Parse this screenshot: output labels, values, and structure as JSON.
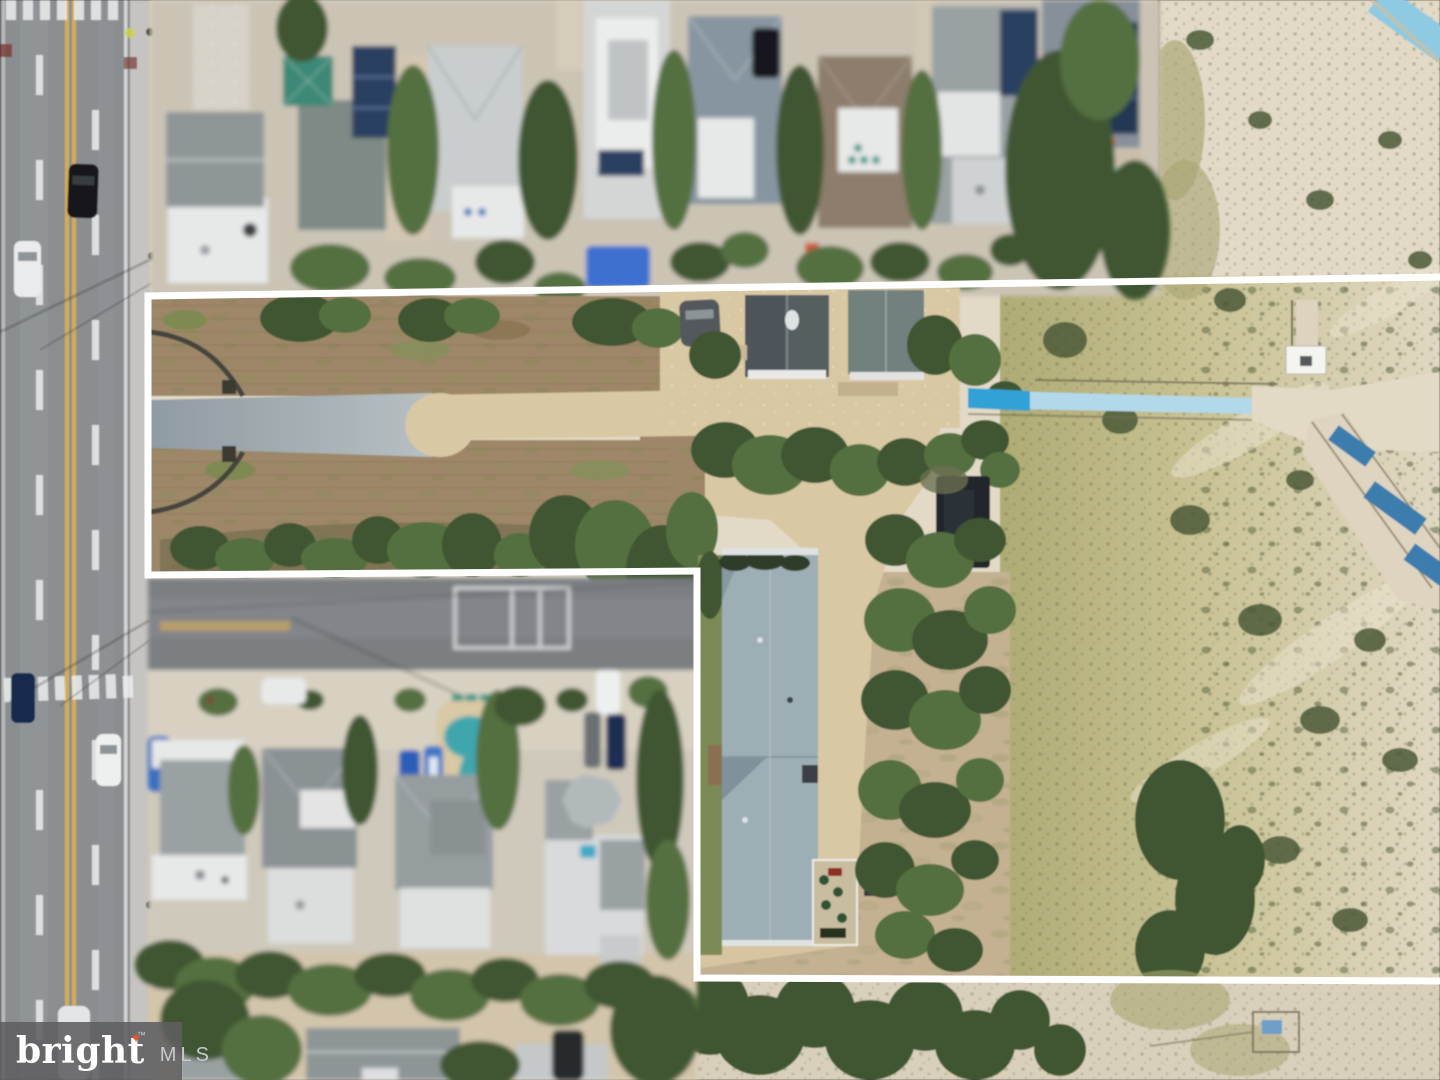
{
  "watermark": {
    "brand": "bright",
    "star": "✦",
    "tm": "™",
    "suffix": "MLS"
  },
  "boundary": {
    "color": "#ffffff",
    "stroke_width": 7,
    "points": [
      [
        1444,
        277
      ],
      [
        148,
        296
      ],
      [
        148,
        575
      ],
      [
        697,
        571
      ],
      [
        697,
        978
      ],
      [
        1444,
        981
      ]
    ]
  },
  "palette": {
    "boundary_white": "#ffffff",
    "road_asphalt": "#8b8e91",
    "road_marking_white": "#eceeee",
    "road_marking_yellow": "#d9ae4e",
    "shoulder_concrete": "#c6c4c0",
    "street_asphalt": "#7c7f82",
    "apron_concrete": "#d8d1c2",
    "lot_dirt": "#9d8767",
    "lot_grass_green": "#7f8a52",
    "dirt_road_sand": "#d9c8a4",
    "paved_stub_gray": "#9aa3a8",
    "tree_dark": "#3f5730",
    "tree_mid": "#547040",
    "dune_sand": "#e2dac7",
    "dune_grass": "#b5b07c",
    "house_roof_gray": "#8f9698",
    "house_white": "#e7e8e8",
    "roof_teal": "#3e8876",
    "roof_brown": "#8d7d6c",
    "solar_navy": "#2b3f60",
    "pool_teal": "#3fa6ad",
    "tarp_blue": "#3d6fd0",
    "boardwalk_blue": "#b3d8e9",
    "boardwalk_bright": "#31a2d6",
    "walkway_navy": "#3c7dad",
    "car_white": "#eef0f0",
    "car_dark": "#17191d",
    "car_blue": "#2a5fb8",
    "logo_bg": "#5e5f61",
    "logo_text": "#ffffff",
    "logo_star": "#e8542e",
    "logo_mls": "#c7c9cb"
  }
}
